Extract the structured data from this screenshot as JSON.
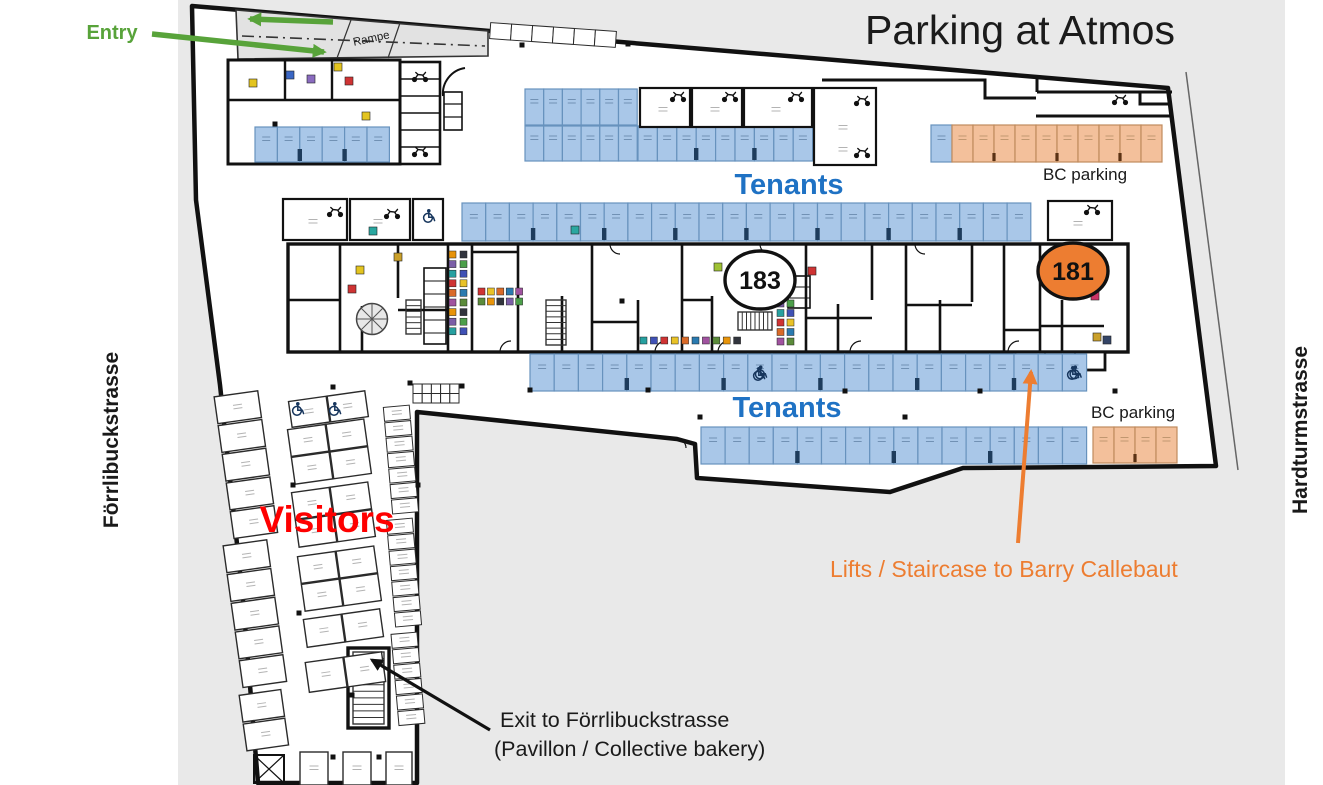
{
  "title": {
    "text": "Parking at Atmos",
    "color": "#1b1b1b"
  },
  "annotations": {
    "entry": {
      "text": "Entry",
      "color": "#58a33a"
    },
    "rampe": {
      "text": "Rampe",
      "color": "#222222"
    },
    "tenants_top": {
      "text": "Tenants",
      "color": "#1f72c4"
    },
    "tenants_bottom": {
      "text": "Tenants",
      "color": "#1f72c4"
    },
    "bc_top": {
      "text": "BC parking",
      "color": "#1a1a1a"
    },
    "bc_bottom": {
      "text": "BC parking",
      "color": "#1a1a1a"
    },
    "visitors": {
      "text": "Visitors",
      "color": "#fe0000"
    },
    "lifts": {
      "text": "Lifts / Staircase to Barry Callebaut",
      "color": "#ed7d31"
    },
    "exit_line1": {
      "text": "Exit to Förrlibuckstrasse",
      "color": "#1a1a1a"
    },
    "exit_line2": {
      "text": "(Pavillon / Collective bakery)",
      "color": "#1a1a1a"
    },
    "street_left": {
      "text": "Förrlibuckstrasse",
      "color": "#1a1a1a"
    },
    "street_right": {
      "text": "Hardturmstrasse",
      "color": "#1a1a1a"
    }
  },
  "badges": {
    "b183": {
      "text": "183",
      "fill": "#ffffff",
      "stroke": "#111111"
    },
    "b181": {
      "text": "181",
      "fill": "#ed7d31",
      "stroke": "#111111"
    }
  },
  "palette": {
    "background_gray": "#e9e9e9",
    "plan_fill": "#ffffff",
    "wall": "#111111",
    "ramp_fill": "#e2e2e2",
    "tenant_fill": "#a9c7e8",
    "tenant_stroke": "#6792bd",
    "bc_fill": "#f3c09b",
    "bc_stroke": "#c08b5d",
    "pillar_navy": "#1e3c5c",
    "pillar_brown": "#5a3214",
    "visitor_stroke": "#2b2b2b",
    "green": "#58a33a",
    "orange": "#ed7d31",
    "black_arrow": "#111111",
    "wheelchair": "#17365d"
  },
  "parking_rows": [
    {
      "name": "upper-left-tenants",
      "type": "tenant",
      "x": 255,
      "y": 127,
      "cols": 6,
      "cw": 22.4,
      "ch": 35,
      "pillar_every": 2
    },
    {
      "name": "mid-block-top",
      "type": "tenant",
      "x": 525,
      "y": 89,
      "cols": 6,
      "cw": 18.7,
      "ch": 36
    },
    {
      "name": "mid-block-bottom",
      "type": "tenant",
      "x": 525,
      "y": 126,
      "cols": 6,
      "cw": 18.7,
      "ch": 35
    },
    {
      "name": "mid-row",
      "type": "tenant",
      "x": 638,
      "y": 126,
      "cols": 9,
      "cw": 19.4,
      "ch": 35,
      "pillar_every": 3
    },
    {
      "name": "bc-top",
      "type": "bc",
      "x": 931,
      "y": 125,
      "cols": 11,
      "cw": 21,
      "ch": 37,
      "first_blue": true,
      "dividers": [
        3,
        6,
        9
      ]
    },
    {
      "name": "tenants-upper",
      "type": "tenant",
      "x": 462,
      "y": 203,
      "cols": 24,
      "cw": 23.7,
      "ch": 38,
      "pillar_every": 3
    },
    {
      "name": "tenants-lower-1",
      "type": "tenant",
      "x": 530,
      "y": 354,
      "cols": 23,
      "cw": 24.2,
      "ch": 37,
      "pillar_every": 4,
      "wheelchairs": [
        9,
        22
      ]
    },
    {
      "name": "tenants-lower-2",
      "type": "tenant",
      "x": 701,
      "y": 427,
      "cols": 16,
      "cw": 24.1,
      "ch": 37,
      "pillar_every": 4
    },
    {
      "name": "bc-bottom",
      "type": "bc",
      "x": 1093,
      "y": 427,
      "cols": 4,
      "cw": 21,
      "ch": 36,
      "dividers": [
        2
      ]
    }
  ],
  "visitor_clusters": [
    {
      "x": 224,
      "y": 393,
      "cols": 1,
      "rows": 5,
      "cw": 44,
      "ch": 27,
      "gap": 2,
      "rot": -8
    },
    {
      "x": 233,
      "y": 542,
      "cols": 1,
      "rows": 5,
      "cw": 44,
      "ch": 27,
      "gap": 2,
      "rot": -8
    },
    {
      "x": 243,
      "y": 692,
      "cols": 1,
      "rows": 2,
      "cw": 42,
      "ch": 27,
      "gap": 2,
      "rot": -8
    },
    {
      "x": 290,
      "y": 396,
      "cols": 2,
      "rows": 1,
      "cw": 38,
      "ch": 26,
      "gap": 1,
      "rot": -8
    },
    {
      "x": 291,
      "y": 424,
      "cols": 2,
      "rows": 2,
      "cw": 38,
      "ch": 27,
      "gap": 1,
      "rot": -8
    },
    {
      "x": 295,
      "y": 487,
      "cols": 2,
      "rows": 2,
      "cw": 38,
      "ch": 27,
      "gap": 1,
      "rot": -8
    },
    {
      "x": 301,
      "y": 551,
      "cols": 2,
      "rows": 2,
      "cw": 38,
      "ch": 27,
      "gap": 1,
      "rot": -8
    },
    {
      "x": 305,
      "y": 614,
      "cols": 2,
      "rows": 1,
      "cw": 38,
      "ch": 28,
      "gap": 1,
      "rot": -8
    },
    {
      "x": 307,
      "y": 657,
      "cols": 2,
      "rows": 1,
      "cw": 38,
      "ch": 30,
      "gap": 1,
      "rot": -8
    },
    {
      "x": 300,
      "y": 752,
      "cols": 1,
      "rows": 1,
      "cw": 28,
      "ch": 33,
      "gap": 0,
      "rot": 0
    },
    {
      "x": 343,
      "y": 752,
      "cols": 1,
      "rows": 1,
      "cw": 28,
      "ch": 33,
      "gap": 0,
      "rot": 0
    },
    {
      "x": 386,
      "y": 752,
      "cols": 1,
      "rows": 1,
      "cw": 26,
      "ch": 33,
      "gap": 0,
      "rot": 0
    },
    {
      "x": 388,
      "y": 406,
      "cols": 1,
      "rows": 7,
      "cw": 26,
      "ch": 14,
      "gap": 1.5,
      "rot": -5,
      "small": true
    },
    {
      "x": 391,
      "y": 519,
      "cols": 1,
      "rows": 7,
      "cw": 26,
      "ch": 14,
      "gap": 1.5,
      "rot": -5,
      "small": true
    },
    {
      "x": 395,
      "y": 633,
      "cols": 1,
      "rows": 6,
      "cw": 26,
      "ch": 14,
      "gap": 1.5,
      "rot": -5,
      "small": true
    },
    {
      "x": 413,
      "y": 384,
      "cols": 5,
      "rows": 2,
      "cw": 9.2,
      "ch": 9.5,
      "gap": 0,
      "rot": 0,
      "plain": true
    },
    {
      "x": 490,
      "y": 27,
      "cols": 6,
      "rows": 1,
      "cw": 21,
      "ch": 16,
      "gap": 0,
      "rot": 4,
      "plain": true
    }
  ],
  "label_boxes": [
    {
      "x": 283,
      "y": 199,
      "w": 64,
      "h": 41
    },
    {
      "x": 350,
      "y": 199,
      "w": 60,
      "h": 41
    },
    {
      "x": 413,
      "y": 199,
      "w": 30,
      "h": 41
    },
    {
      "x": 640,
      "y": 88,
      "w": 50,
      "h": 39
    },
    {
      "x": 692,
      "y": 88,
      "w": 50,
      "h": 39
    },
    {
      "x": 744,
      "y": 88,
      "w": 68,
      "h": 39
    },
    {
      "x": 814,
      "y": 88,
      "w": 62,
      "h": 77
    },
    {
      "x": 1048,
      "y": 201,
      "w": 64,
      "h": 39
    }
  ],
  "box_label_dashes": [
    [
      313,
      222
    ],
    [
      378,
      222
    ],
    [
      663,
      110
    ],
    [
      715,
      110
    ],
    [
      776,
      110
    ],
    [
      843,
      128
    ],
    [
      1078,
      224
    ],
    [
      843,
      150
    ]
  ],
  "moto_icons": [
    [
      335,
      211
    ],
    [
      392,
      213
    ],
    [
      678,
      96
    ],
    [
      730,
      96
    ],
    [
      796,
      96
    ],
    [
      862,
      100
    ],
    [
      862,
      152
    ],
    [
      1092,
      209
    ],
    [
      420,
      76
    ],
    [
      1120,
      99
    ],
    [
      420,
      151
    ]
  ],
  "wheelchair_icons": [
    [
      428,
      216
    ],
    [
      758,
      374
    ],
    [
      1072,
      373
    ],
    [
      297,
      409
    ],
    [
      334,
      409
    ]
  ],
  "icon_strips": [
    {
      "x": 449,
      "y": 251,
      "dx": 11,
      "dy": 9.6,
      "cols": 2,
      "rows": 9
    },
    {
      "x": 478,
      "y": 288,
      "dx": 9.4,
      "dy": 10,
      "cols": 5,
      "rows": 2
    },
    {
      "x": 640,
      "y": 337,
      "dx": 10.4,
      "dy": 0,
      "cols": 10,
      "rows": 1
    },
    {
      "x": 777,
      "y": 300,
      "dx": 10,
      "dy": 9.5,
      "cols": 2,
      "rows": 5
    }
  ],
  "icon_palette": [
    "#e8940a",
    "#31343d",
    "#7b5ea7",
    "#4c9f4a",
    "#26a0a0",
    "#3f51b5",
    "#cf3333",
    "#e9c227",
    "#d96a28",
    "#2a7ab0",
    "#a0529f",
    "#5b8b3a"
  ],
  "icon_singles": [
    [
      373,
      231,
      "#2aa7a0"
    ],
    [
      360,
      270,
      "#e3c41f"
    ],
    [
      812,
      271,
      "#cf3333"
    ],
    [
      718,
      267,
      "#9fc234"
    ],
    [
      253,
      83,
      "#e3c41f"
    ],
    [
      290,
      75,
      "#3a66c4"
    ],
    [
      311,
      79,
      "#8a6bbf"
    ],
    [
      349,
      81,
      "#cf3333"
    ],
    [
      338,
      67,
      "#e3c41f"
    ],
    [
      366,
      116,
      "#e3c41f"
    ],
    [
      1095,
      296,
      "#cc3366"
    ],
    [
      1097,
      337,
      "#caa02a"
    ],
    [
      1107,
      340,
      "#334466"
    ],
    [
      352,
      289,
      "#cf3333"
    ],
    [
      398,
      257,
      "#caa02a"
    ],
    [
      575,
      230,
      "#2aa7a0"
    ]
  ],
  "column_dots": [
    [
      333,
      387
    ],
    [
      410,
      383
    ],
    [
      462,
      386
    ],
    [
      530,
      390
    ],
    [
      648,
      390
    ],
    [
      845,
      391
    ],
    [
      980,
      391
    ],
    [
      1115,
      391
    ],
    [
      700,
      417
    ],
    [
      905,
      417
    ],
    [
      522,
      45
    ],
    [
      628,
      44
    ],
    [
      275,
      124
    ],
    [
      293,
      485
    ],
    [
      299,
      613
    ],
    [
      352,
      695
    ],
    [
      333,
      757
    ],
    [
      379,
      757
    ],
    [
      418,
      485
    ],
    [
      622,
      301
    ]
  ]
}
